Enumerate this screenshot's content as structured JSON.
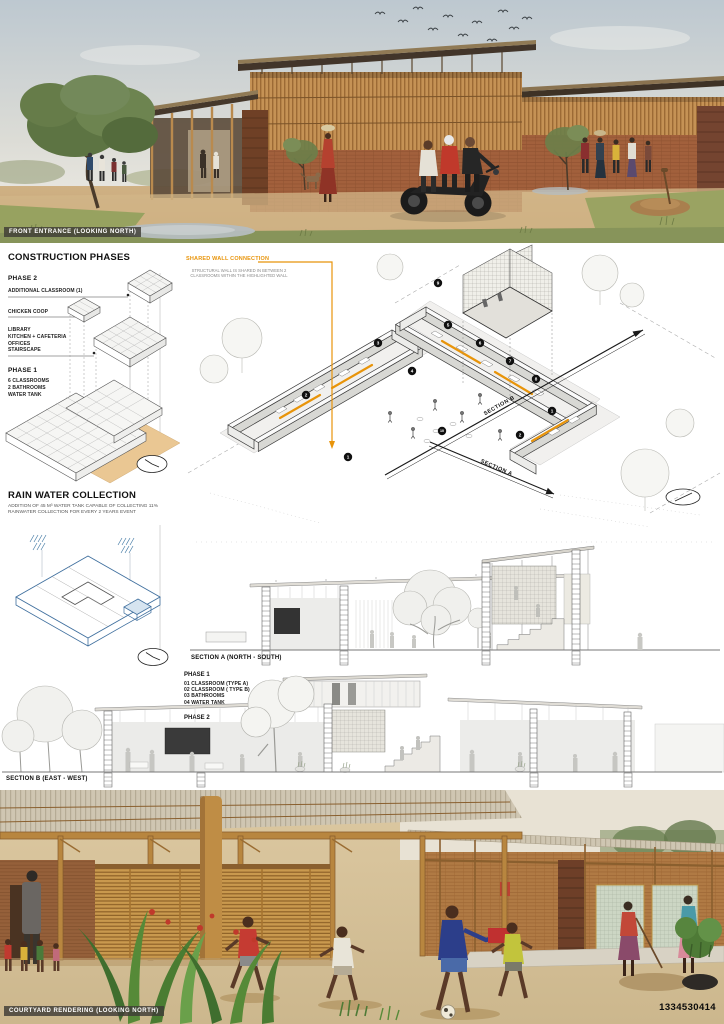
{
  "colors": {
    "accent_orange": "#E8940A",
    "annotation_blue": "#4A7FA8",
    "brick": "#A2603C",
    "timber": "#C28B4E"
  },
  "icons": {
    "construction_duration": "clock-icon",
    "rainwater_duration": "clock-icon",
    "site_marker": "ellipse-clock-icon"
  },
  "top_render": {
    "caption": "FRONT ENTRANCE (LOOKING NORTH)"
  },
  "construction_phases": {
    "title": "CONSTRUCTION PHASES",
    "phase2_label": "PHASE 2",
    "callout_additional": "ADDITIONAL CLASSROOM (1)",
    "callout_coop": "CHICKEN COOP",
    "callout_library_lines": [
      "LIBRARY",
      "KITCHEN + CAFETERIA",
      "OFFICES",
      "STAIRSCAPE"
    ],
    "phase1_label": "PHASE 1",
    "phase1_lines": [
      "6 CLASSROOMS",
      "2 BATHROOMS",
      "WATER TANK"
    ]
  },
  "rain_water": {
    "title": "RAIN WATER COLLECTION",
    "body": "ADDITION OF 45 M³ WATER TANK CAPABLE OF COLLECTING 11% RAINWATER COLLECTION FOR EVERY 2 YEARS  EVENT"
  },
  "axon": {
    "shared_wall_title": "SHARED WALL CONNECTION",
    "shared_wall_caption": "STRUCTURAL WALL IS SHARED IN BETWEEN 2 CLASSROOMS WITHIN THE HIGHLIGHTED WALL",
    "section_a_arrow": "SECTION A",
    "section_b_arrow": "SECTION B",
    "plan_markers": [
      "1",
      "2",
      "1",
      "2",
      "3",
      "4",
      "5",
      "6",
      "7",
      "8",
      "9",
      "10"
    ],
    "legend": {
      "phase1_label": "PHASE 1",
      "phase1_items": [
        "01 CLASSROOM  (TYPE A)",
        "02 CLASSROOM  ( TYPE B)",
        "03 BATHROOMS",
        "04 WATER TANK"
      ],
      "phase2_label": "PHASE 2",
      "phase2_items": [
        "05 OFFICE",
        "06 KITCHEN",
        "07 CAFETERIA + STAIRSCAPE",
        "08 LIBRARY",
        "09 CHICKEN COOP",
        "10 FOOD GROWING GARDEN /",
        "HEARTH"
      ]
    }
  },
  "sections": {
    "a_label": "SECTION A (NORTH - SOUTH)",
    "b_label": "SECTION B (EAST - WEST)"
  },
  "bottom_render": {
    "caption": "COURTYARD RENDERING (LOOKING NORTH)",
    "id_number": "1334530414"
  }
}
